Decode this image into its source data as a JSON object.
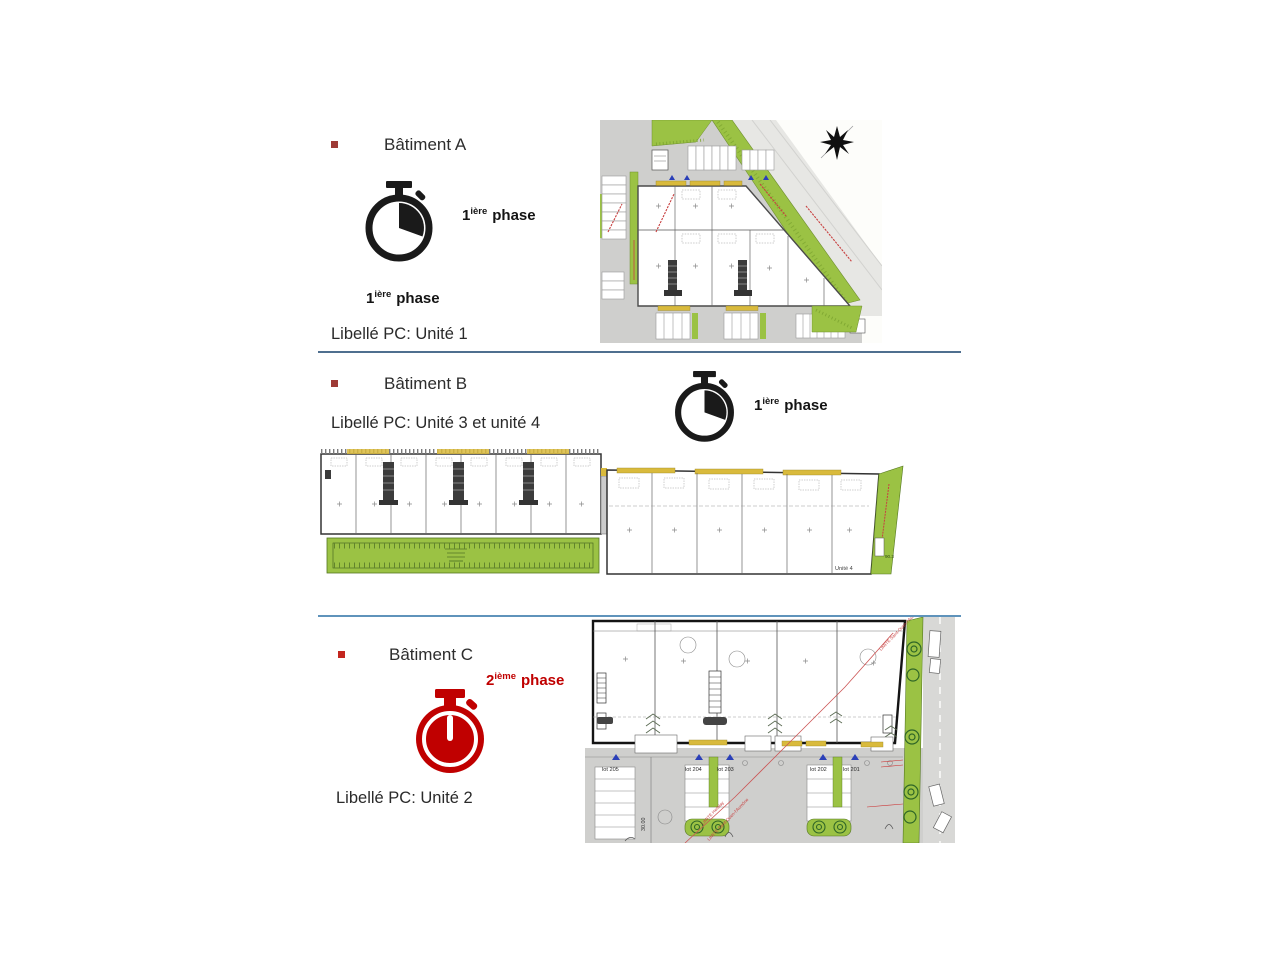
{
  "colors": {
    "phase_red": "#c00000",
    "stopwatch_black": "#1a1a1a",
    "bullet_maroon": "#9e3a36",
    "bullet_red": "#c3261f",
    "divider_dark_blue": "#4f6f8f",
    "divider_light_blue": "#5f93bb",
    "plan_green": "#9bc244",
    "plan_yellow": "#d9ba3c",
    "plan_road_gray": "#cfcfcd",
    "annotation_red": "#c84040",
    "marker_blue": "#2a3fb8"
  },
  "icons": {
    "bullet": "small-square",
    "stopwatch_phase1": "stopwatch-icon",
    "stopwatch_phase2": "stopwatch-icon-red",
    "compass_north": "compass-star-icon"
  },
  "sections": {
    "a": {
      "title": "Bâtiment A",
      "phase": {
        "num": "1",
        "sup": "ière",
        "word": "phase"
      },
      "libelle": "Libellé PC: Unité 1"
    },
    "b": {
      "title": "Bâtiment B",
      "phase": {
        "num": "1",
        "sup": "ière",
        "word": "phase"
      },
      "libelle": "Libellé PC: Unité 3 et unité 4"
    },
    "c": {
      "title": "Bâtiment C",
      "phase": {
        "num": "2",
        "sup": "ième",
        "word": "phase"
      },
      "libelle": "Libellé PC: Unité 2"
    }
  },
  "plan_b": {
    "unit_label": "Unité 4",
    "green_dim": "90.3"
  },
  "plan_c": {
    "lots": [
      "lot 205",
      "lot 204",
      "lot 203",
      "lot 202",
      "lot 201"
    ],
    "dimension": "30.00",
    "boundary_1": "LIMITE Herblay",
    "boundary_2": "LIMITE Saint-Ouen-l'Aumône"
  }
}
